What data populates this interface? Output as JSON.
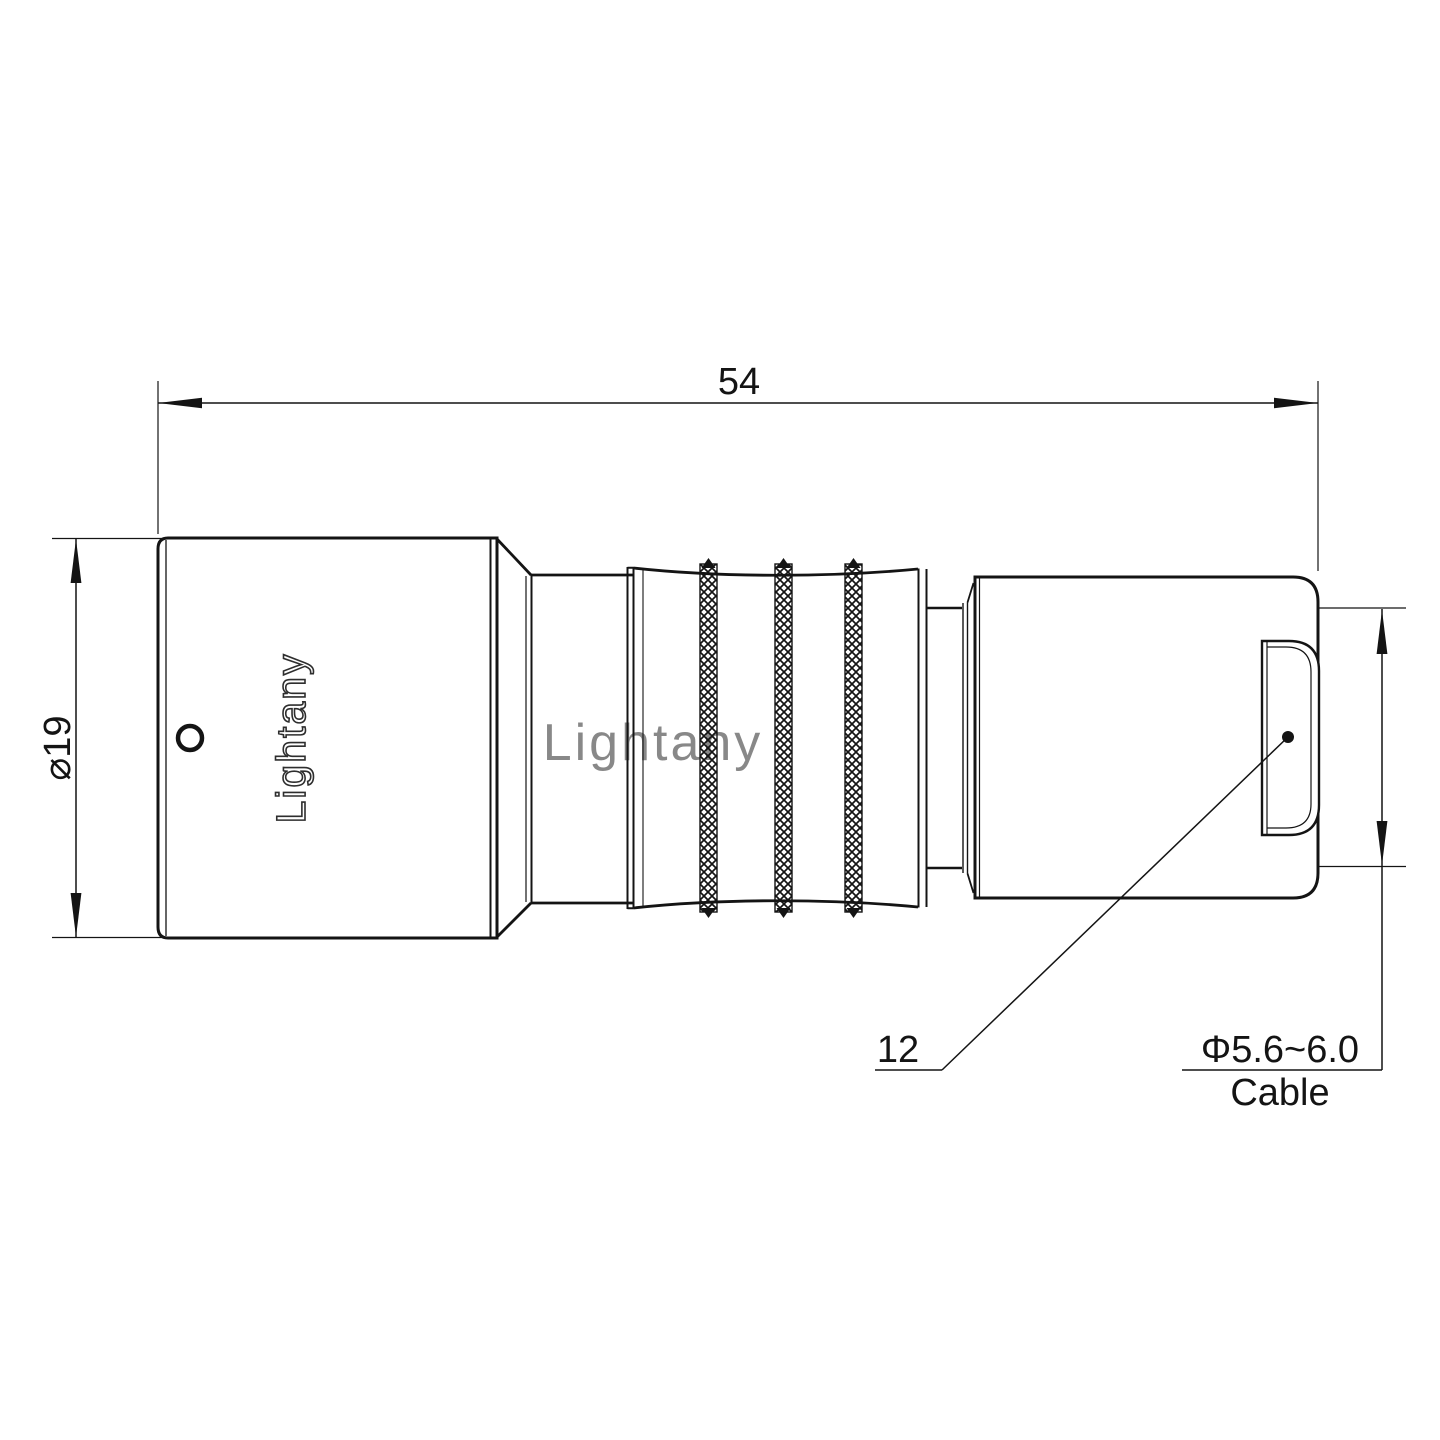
{
  "page": {
    "background": "#ffffff"
  },
  "style": {
    "line_color": "#141414"
  },
  "watermark": {
    "text": "Lightany",
    "color": "#e79f9f"
  },
  "connector": {
    "engraved_logo": "Lightany",
    "engraving_color": "#2e2e2e"
  },
  "dimensions": {
    "overall_length": "54",
    "front_diameter": "⌀19",
    "rear_flat": "12",
    "cable_range": "Φ5.6~6.0",
    "cable_label": "Cable"
  }
}
